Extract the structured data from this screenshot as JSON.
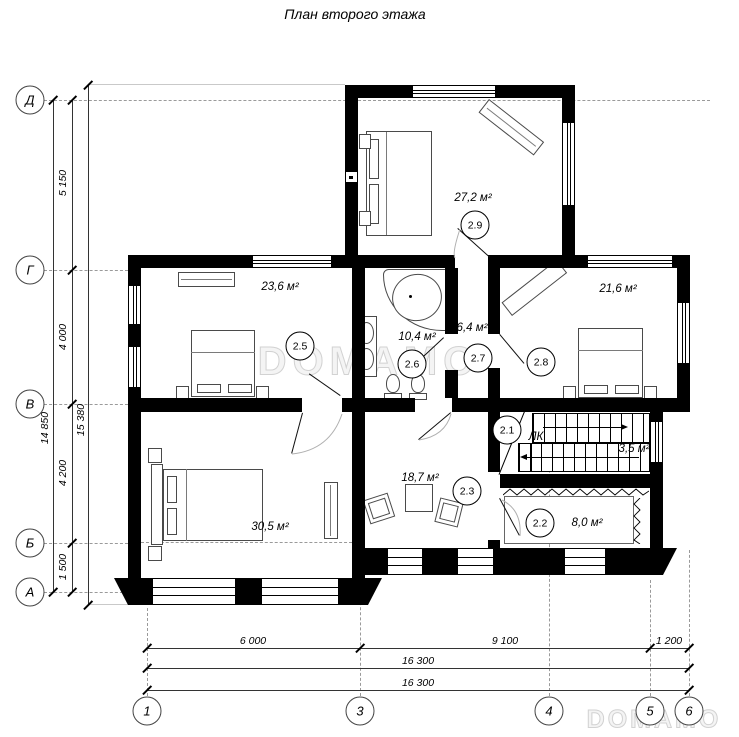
{
  "title": "План второго этажа",
  "watermarks": {
    "center": "DOMAMO",
    "corner": "DOMAMO"
  },
  "rooms": {
    "r29": {
      "num": "2.9",
      "area": "27,2 м²"
    },
    "r25": {
      "num": "2.5",
      "area": "23,6 м²"
    },
    "r26": {
      "num": "2.6",
      "area": "10,4 м²"
    },
    "r27": {
      "num": "2.7",
      "area": "6,4 м²"
    },
    "r28": {
      "num": "2.8",
      "area": "21,6 м²"
    },
    "r21": {
      "num": "2.1",
      "tag": "ЛК",
      "area": "3,5 м²"
    },
    "r23": {
      "num": "2.3",
      "area": "18,7 м²"
    },
    "r22": {
      "num": "2.2",
      "area": "8,0 м²"
    },
    "r24": {
      "area": "30,5 м²"
    }
  },
  "axes": {
    "row_d": "Д",
    "row_g": "Г",
    "row_v": "В",
    "row_b": "Б",
    "row_a": "А",
    "col_1": "1",
    "col_3": "3",
    "col_4": "4",
    "col_5": "5",
    "col_6": "6"
  },
  "dims": {
    "seg_dg": "5 150",
    "seg_gv": "4 000",
    "seg_vb": "4 200",
    "seg_ba": "1 500",
    "total_left_1": "14 850",
    "total_left_2": "15 380",
    "seg_13": "6 000",
    "seg_35": "9 100",
    "seg_56": "1 200",
    "total_bottom_1": "16 300",
    "total_bottom_2": "16 300"
  }
}
